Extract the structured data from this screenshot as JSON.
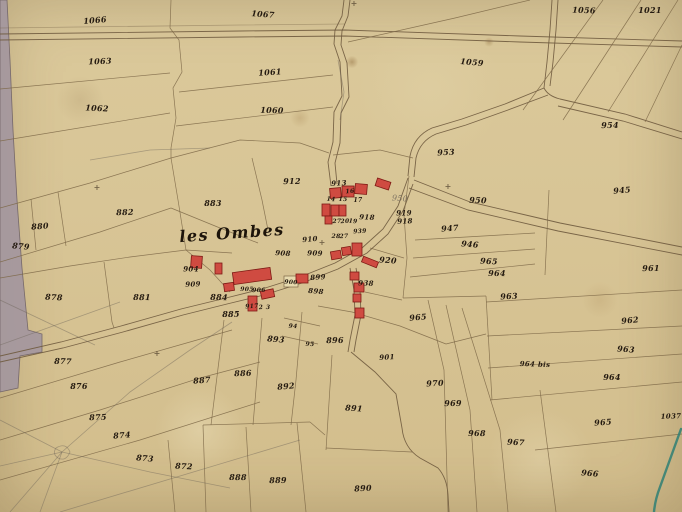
{
  "map": {
    "place_label": "les Ombes",
    "map_kind": "hand-drawn cadastral parcel map",
    "colors": {
      "paper": "#d8c596",
      "ink": "#241a10",
      "parcel_line": "#7d6747",
      "road_line": "#6f5a3e",
      "pencil": "#6b6257",
      "gray_road": "#a4979f",
      "building_fill": "#cf4b41",
      "building_stroke": "#7e1a14",
      "stream_teal": "#2e7f74"
    },
    "parcel_labels": [
      {
        "t": "1066",
        "x": 95,
        "y": 20
      },
      {
        "t": "1067",
        "x": 263,
        "y": 14
      },
      {
        "t": "1056",
        "x": 584,
        "y": 10
      },
      {
        "t": "1021",
        "x": 650,
        "y": 10
      },
      {
        "t": "1063",
        "x": 100,
        "y": 61
      },
      {
        "t": "1061",
        "x": 270,
        "y": 72
      },
      {
        "t": "1059",
        "x": 472,
        "y": 62
      },
      {
        "t": "1062",
        "x": 97,
        "y": 108
      },
      {
        "t": "1060",
        "x": 272,
        "y": 110
      },
      {
        "t": "954",
        "x": 610,
        "y": 125
      },
      {
        "t": "953",
        "x": 446,
        "y": 152
      },
      {
        "t": "945",
        "x": 622,
        "y": 190
      },
      {
        "t": "950",
        "x": 400,
        "y": 199,
        "c": "pencil"
      },
      {
        "t": "950",
        "x": 478,
        "y": 200
      },
      {
        "t": "919",
        "x": 404,
        "y": 213,
        "s": 7
      },
      {
        "t": "918",
        "x": 405,
        "y": 221,
        "s": 7
      },
      {
        "t": "947",
        "x": 450,
        "y": 228
      },
      {
        "t": "946",
        "x": 470,
        "y": 244
      },
      {
        "t": "965",
        "x": 489,
        "y": 261
      },
      {
        "t": "964",
        "x": 497,
        "y": 273
      },
      {
        "t": "961",
        "x": 651,
        "y": 268
      },
      {
        "t": "963",
        "x": 509,
        "y": 296
      },
      {
        "t": "962",
        "x": 630,
        "y": 320
      },
      {
        "t": "963",
        "x": 626,
        "y": 349
      },
      {
        "t": "964 bis",
        "x": 535,
        "y": 364,
        "s": 7
      },
      {
        "t": "964",
        "x": 612,
        "y": 377
      },
      {
        "t": "1037",
        "x": 671,
        "y": 416,
        "s": 7
      },
      {
        "t": "965",
        "x": 603,
        "y": 422
      },
      {
        "t": "966",
        "x": 590,
        "y": 473
      },
      {
        "t": "967",
        "x": 516,
        "y": 442
      },
      {
        "t": "968",
        "x": 477,
        "y": 433
      },
      {
        "t": "969",
        "x": 453,
        "y": 403
      },
      {
        "t": "970",
        "x": 435,
        "y": 383
      },
      {
        "t": "965",
        "x": 418,
        "y": 317
      },
      {
        "t": "920",
        "x": 388,
        "y": 260
      },
      {
        "t": "938",
        "x": 366,
        "y": 283,
        "s": 7
      },
      {
        "t": "883",
        "x": 213,
        "y": 203
      },
      {
        "t": "882",
        "x": 125,
        "y": 212
      },
      {
        "t": "880",
        "x": 40,
        "y": 226
      },
      {
        "t": "879",
        "x": 21,
        "y": 246
      },
      {
        "t": "878",
        "x": 54,
        "y": 297
      },
      {
        "t": "881",
        "x": 142,
        "y": 297
      },
      {
        "t": "912",
        "x": 292,
        "y": 181
      },
      {
        "t": "913",
        "x": 339,
        "y": 183,
        "s": 7
      },
      {
        "t": "16",
        "x": 350,
        "y": 192,
        "s": 6
      },
      {
        "t": "14",
        "x": 331,
        "y": 200,
        "s": 6
      },
      {
        "t": "15",
        "x": 343,
        "y": 200,
        "s": 6
      },
      {
        "t": "17",
        "x": 358,
        "y": 201,
        "s": 6
      },
      {
        "t": "27",
        "x": 337,
        "y": 222,
        "s": 6
      },
      {
        "t": "20",
        "x": 345,
        "y": 222,
        "s": 6
      },
      {
        "t": "19",
        "x": 353,
        "y": 222,
        "s": 6
      },
      {
        "t": "918",
        "x": 367,
        "y": 217,
        "s": 7
      },
      {
        "t": "28",
        "x": 336,
        "y": 237,
        "s": 6
      },
      {
        "t": "27",
        "x": 344,
        "y": 237,
        "s": 6
      },
      {
        "t": "939",
        "x": 360,
        "y": 232,
        "s": 6
      },
      {
        "t": "910",
        "x": 310,
        "y": 239,
        "s": 7
      },
      {
        "t": "908",
        "x": 283,
        "y": 253,
        "s": 7
      },
      {
        "t": "909",
        "x": 315,
        "y": 253,
        "s": 7
      },
      {
        "t": "904",
        "x": 191,
        "y": 269,
        "s": 7
      },
      {
        "t": "909",
        "x": 193,
        "y": 284,
        "s": 7
      },
      {
        "t": "899",
        "x": 318,
        "y": 277,
        "s": 7
      },
      {
        "t": "898",
        "x": 316,
        "y": 291,
        "s": 7
      },
      {
        "t": "900",
        "x": 291,
        "y": 283,
        "s": 6
      },
      {
        "t": "905",
        "x": 247,
        "y": 290,
        "s": 6
      },
      {
        "t": "906",
        "x": 259,
        "y": 291,
        "s": 6
      },
      {
        "t": "917",
        "x": 252,
        "y": 307,
        "s": 6
      },
      {
        "t": "2",
        "x": 261,
        "y": 308,
        "s": 6
      },
      {
        "t": "3",
        "x": 268,
        "y": 308,
        "s": 6
      },
      {
        "t": "884",
        "x": 219,
        "y": 297
      },
      {
        "t": "885",
        "x": 231,
        "y": 314
      },
      {
        "t": "886",
        "x": 243,
        "y": 373
      },
      {
        "t": "887",
        "x": 202,
        "y": 380
      },
      {
        "t": "893",
        "x": 276,
        "y": 339
      },
      {
        "t": "94",
        "x": 293,
        "y": 327,
        "s": 6
      },
      {
        "t": "95",
        "x": 310,
        "y": 345,
        "s": 6
      },
      {
        "t": "896",
        "x": 335,
        "y": 340
      },
      {
        "t": "901",
        "x": 387,
        "y": 357,
        "s": 7
      },
      {
        "t": "892",
        "x": 286,
        "y": 386
      },
      {
        "t": "891",
        "x": 354,
        "y": 408
      },
      {
        "t": "877",
        "x": 63,
        "y": 361
      },
      {
        "t": "876",
        "x": 79,
        "y": 386
      },
      {
        "t": "875",
        "x": 98,
        "y": 417
      },
      {
        "t": "874",
        "x": 122,
        "y": 435
      },
      {
        "t": "873",
        "x": 145,
        "y": 458
      },
      {
        "t": "872",
        "x": 184,
        "y": 466
      },
      {
        "t": "888",
        "x": 238,
        "y": 477
      },
      {
        "t": "889",
        "x": 278,
        "y": 480
      },
      {
        "t": "890",
        "x": 363,
        "y": 488
      }
    ],
    "buildings": [
      {
        "x": 233,
        "y": 270,
        "w": 38,
        "h": 12,
        "r": -8
      },
      {
        "x": 224,
        "y": 283,
        "w": 10,
        "h": 8,
        "r": -8
      },
      {
        "x": 215,
        "y": 263,
        "w": 7,
        "h": 11,
        "r": 0
      },
      {
        "x": 191,
        "y": 256,
        "w": 11,
        "h": 12,
        "r": 4
      },
      {
        "x": 248,
        "y": 296,
        "w": 9,
        "h": 15,
        "r": 0
      },
      {
        "x": 261,
        "y": 290,
        "w": 13,
        "h": 8,
        "r": -12
      },
      {
        "x": 296,
        "y": 274,
        "w": 12,
        "h": 9,
        "r": 0
      },
      {
        "x": 330,
        "y": 188,
        "w": 11,
        "h": 10,
        "r": -5
      },
      {
        "x": 342,
        "y": 186,
        "w": 12,
        "h": 11,
        "r": 0
      },
      {
        "x": 355,
        "y": 184,
        "w": 12,
        "h": 10,
        "r": 5
      },
      {
        "x": 322,
        "y": 204,
        "w": 8,
        "h": 12,
        "r": 0
      },
      {
        "x": 331,
        "y": 205,
        "w": 8,
        "h": 11,
        "r": 0
      },
      {
        "x": 339,
        "y": 205,
        "w": 7,
        "h": 11,
        "r": 0
      },
      {
        "x": 325,
        "y": 216,
        "w": 7,
        "h": 8,
        "r": 0
      },
      {
        "x": 376,
        "y": 180,
        "w": 14,
        "h": 8,
        "r": 18
      },
      {
        "x": 331,
        "y": 251,
        "w": 10,
        "h": 8,
        "r": -10
      },
      {
        "x": 342,
        "y": 247,
        "w": 9,
        "h": 8,
        "r": -10
      },
      {
        "x": 352,
        "y": 243,
        "w": 10,
        "h": 13,
        "r": 0
      },
      {
        "x": 362,
        "y": 259,
        "w": 16,
        "h": 6,
        "r": 22
      },
      {
        "x": 350,
        "y": 272,
        "w": 9,
        "h": 8,
        "r": 0
      },
      {
        "x": 354,
        "y": 283,
        "w": 10,
        "h": 9,
        "r": 0
      },
      {
        "x": 353,
        "y": 294,
        "w": 8,
        "h": 8,
        "r": 0
      },
      {
        "x": 355,
        "y": 308,
        "w": 9,
        "h": 10,
        "r": 0
      }
    ],
    "cross_marks": [
      {
        "x": 448,
        "y": 187
      },
      {
        "x": 322,
        "y": 243
      },
      {
        "x": 157,
        "y": 354
      },
      {
        "x": 354,
        "y": 4
      },
      {
        "x": 97,
        "y": 188
      }
    ]
  }
}
